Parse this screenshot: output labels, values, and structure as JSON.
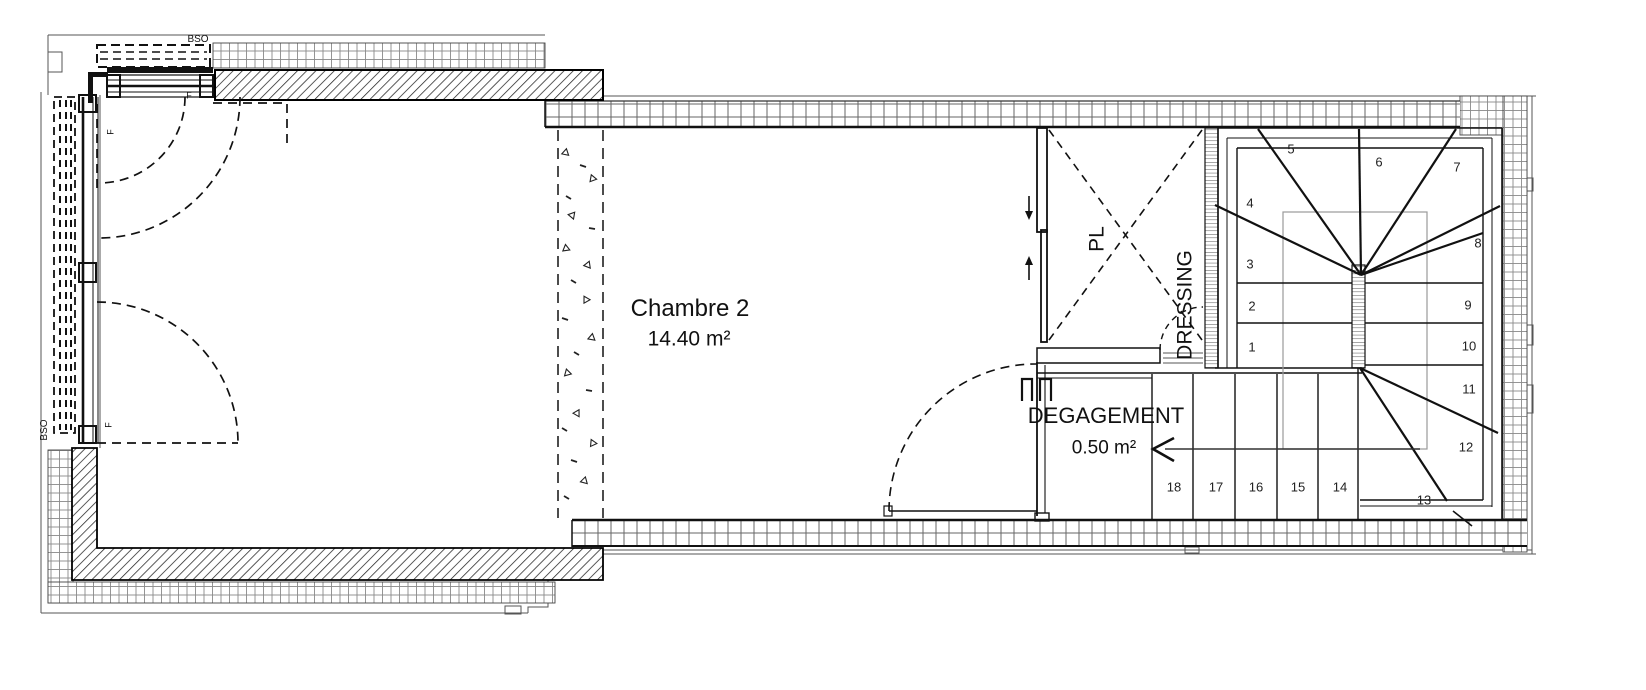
{
  "plan": {
    "title": "floor plan level with Chambre 2, dressing and winder staircase",
    "rooms": {
      "chambre": {
        "name": "Chambre 2",
        "area": "14.40 m²"
      },
      "degagement": {
        "name": "DEGAGEMENT",
        "area": "0.50 m²"
      },
      "closet_label": "PL",
      "dressing_label": "DRESSING"
    },
    "annotations": {
      "bso_top": "BSO",
      "bso_left": "BSO",
      "window_f_top": "F",
      "window_f_left_upper": "F",
      "window_f_left_lower": "F"
    },
    "stair_steps": [
      "1",
      "2",
      "3",
      "4",
      "5",
      "6",
      "7",
      "8",
      "9",
      "10",
      "11",
      "12",
      "13",
      "14",
      "15",
      "16",
      "17",
      "18"
    ]
  },
  "colors": {
    "ink": "#1a1a1a",
    "wall_hatch": "#222222",
    "tile_grid": "#8a8a8a",
    "block_grid": "#666666",
    "opening_grey": "#9a9a9a",
    "background": "#ffffff"
  }
}
